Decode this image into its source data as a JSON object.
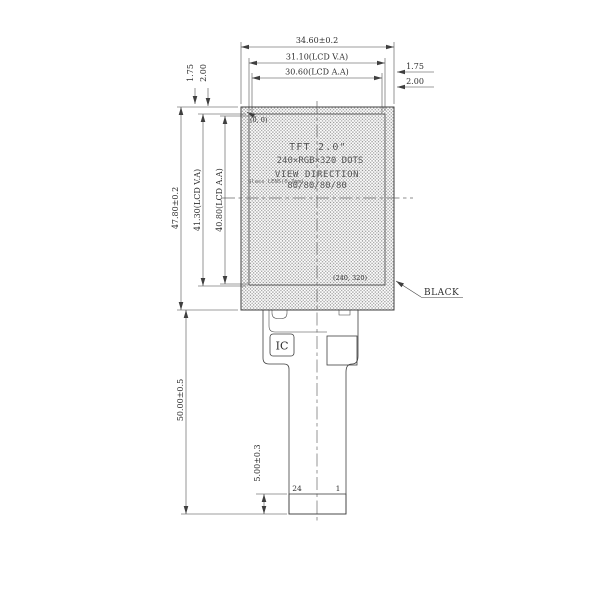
{
  "drawing": {
    "top_dims": {
      "outer": "34.60±0.2",
      "va": "31.10(LCD V.A)",
      "aa": "30.60(LCD A.A)"
    },
    "right_dims": {
      "d1": "1.75",
      "d2": "2.00"
    },
    "left_top_dims": {
      "d1": "1.75",
      "d2": "2.00"
    },
    "left_dims": {
      "outer": "47.80±0.2",
      "va": "41.30(LCD V.A)",
      "aa": "40.80(LCD A.A)"
    },
    "bottom_dims": {
      "fpc_length": "50.00±0.5",
      "contact": "5.00±0.3"
    },
    "screen": {
      "l1": "TFT 2.0\"",
      "l2": "240×RGB×320 DOTS",
      "l3": "VIEW DIRECTION",
      "l4": "80/80/80/80",
      "note": "Glass LENS(0.7mm)"
    },
    "labels": {
      "origin": "(0, 0)",
      "end_px": "(240, 320)",
      "black": "BLACK",
      "ic": "IC",
      "pin_first": "24",
      "pin_last": "1"
    }
  },
  "colors": {
    "ink": "#3f3f3f",
    "stipple": "#8f8f8f",
    "hatch": "#6f6f6f",
    "background": "#ffffff"
  }
}
